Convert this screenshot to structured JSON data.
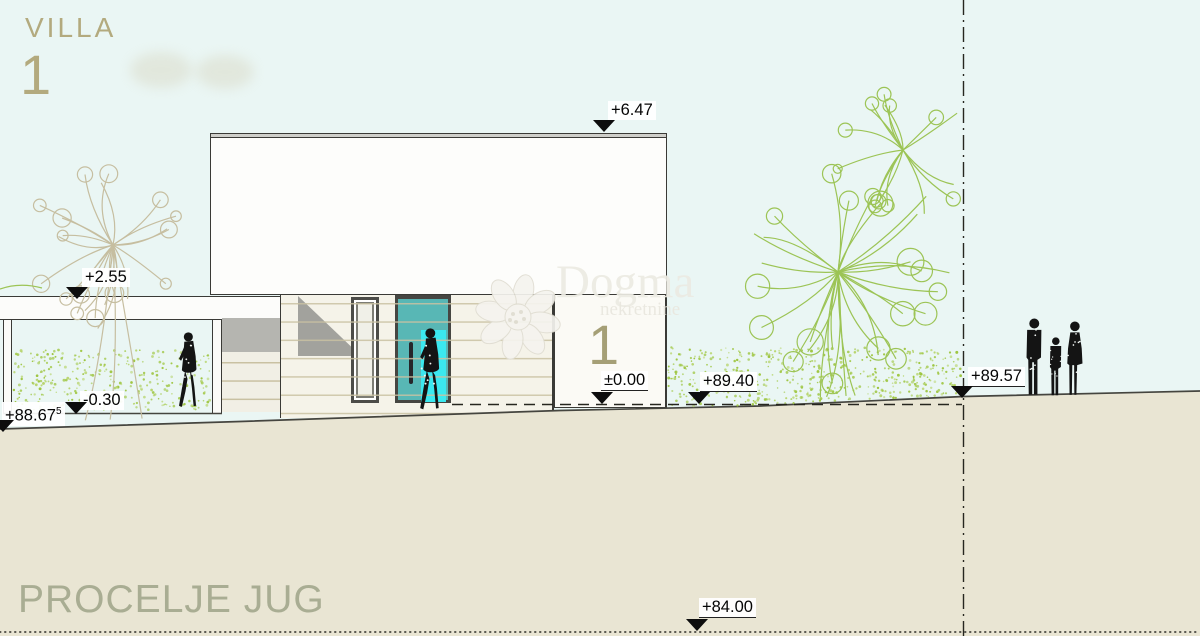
{
  "title": {
    "project": "VILLA",
    "number": "1"
  },
  "sheet": {
    "label": "PROCELJE JUG"
  },
  "building": {
    "number": "1"
  },
  "watermark": {
    "brand": "Dogma",
    "subtitle": "nekretnine"
  },
  "markers": {
    "roof": "+6.47",
    "canopy": "+2.55",
    "carport_floor": "-0.30",
    "terrain_left": "+88.67",
    "terrain_left_sup": "5",
    "entrance": "±0.00",
    "terrain_garden": "+89.40",
    "terrain_boundary": "+89.57",
    "datum": "+84.00"
  },
  "colors": {
    "sky": "#eaf6f4",
    "ground_fill": "#e9e5d3",
    "ground_line": "#45453f",
    "hedge_dot": "#9dc53e",
    "hedge_dot_light": "#b8d56e",
    "plant_green": "#9cc455",
    "plant_tan": "#c6bea0",
    "ink": "#26261f",
    "silhouette": "#141414"
  }
}
